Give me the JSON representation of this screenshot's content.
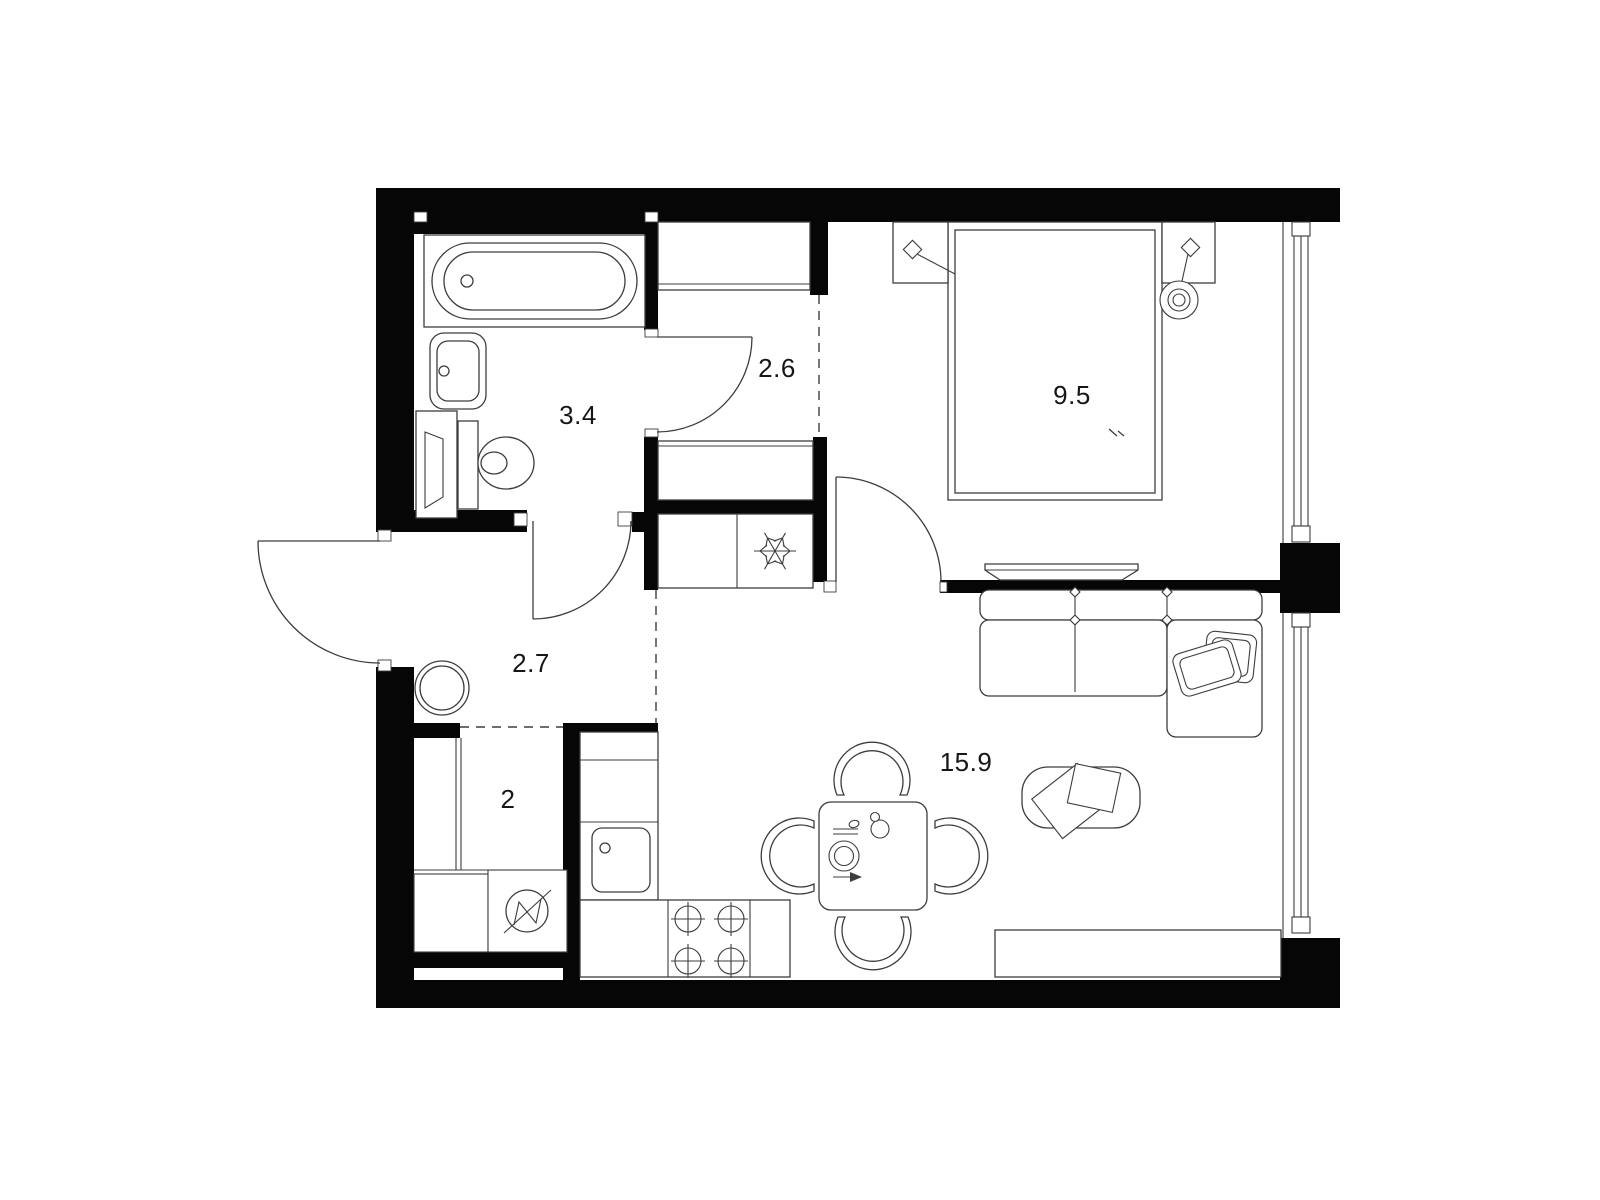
{
  "floorplan": {
    "type": "apartment-floor-plan",
    "rooms": [
      {
        "id": "bathroom",
        "area": "3.4"
      },
      {
        "id": "hall-upper",
        "area": "2.6"
      },
      {
        "id": "bedroom",
        "area": "9.5"
      },
      {
        "id": "hall-entry",
        "area": "2.7"
      },
      {
        "id": "storage",
        "area": "2"
      },
      {
        "id": "kitchen-living",
        "area": "15.9"
      }
    ],
    "icons": {
      "freezer": "snowflake-icon",
      "washer": "washing-machine-circle-zigzag-icon",
      "stove": "four-burner-icon",
      "bath": "bathtub-icon",
      "toilet": "toilet-icon",
      "sink": "sink-icon",
      "bed": "double-bed-icon",
      "sofa": "corner-sofa-icon",
      "table": "dining-table-icon"
    },
    "colors": {
      "walls": "#060606",
      "lines": "#3d3d3d",
      "label": "#161616",
      "bg": "#ffffff"
    }
  }
}
